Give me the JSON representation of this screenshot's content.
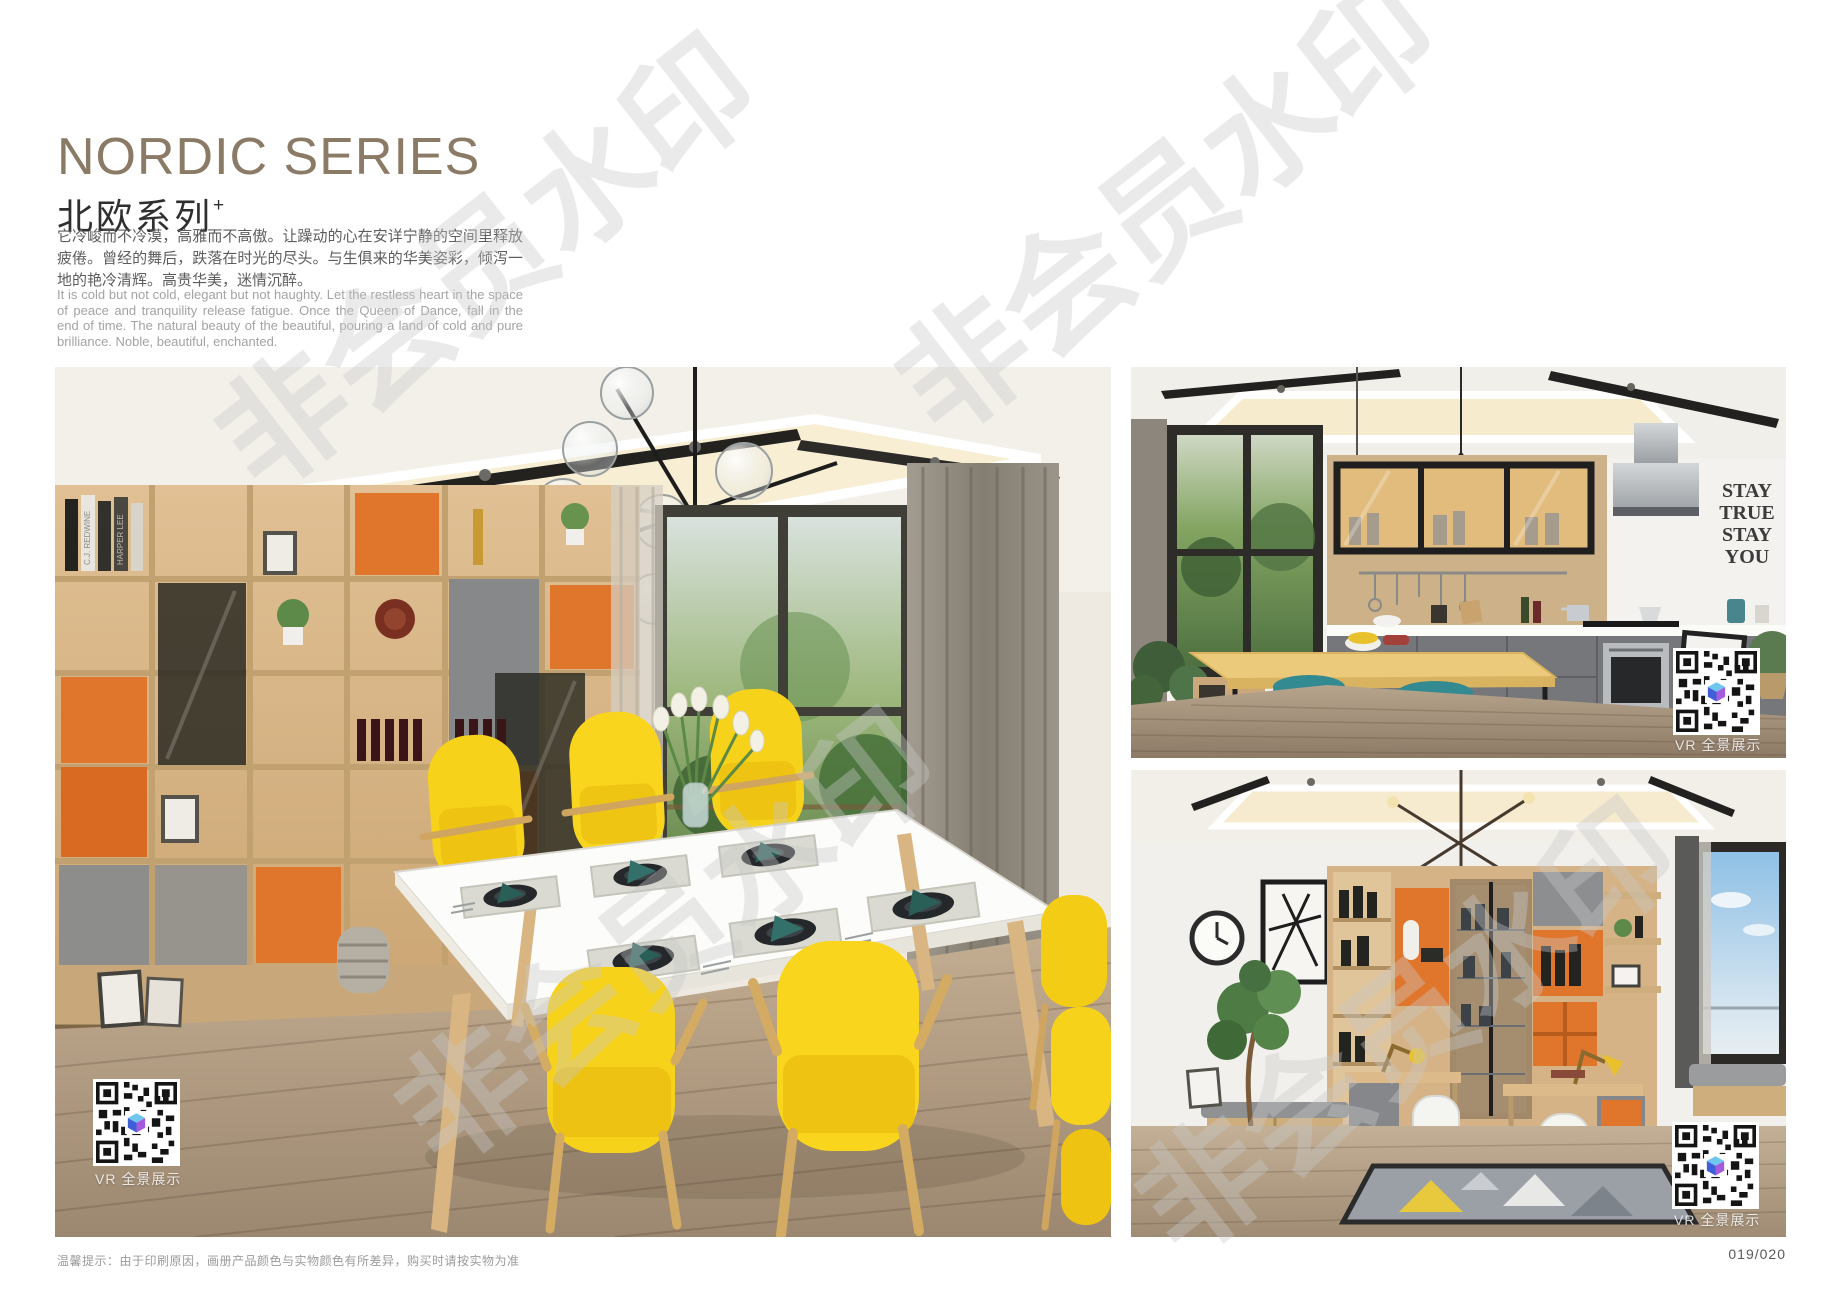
{
  "header": {
    "title_en": "NORDIC SERIES",
    "title_cn": "北欧系列",
    "title_sup": "+",
    "desc_cn": "它冷峻而不冷漠，高雅而不高傲。让躁动的心在安详宁静的空间里释放疲倦。曾经的舞后，跌落在时光的尽头。与生俱来的华美姿彩，倾泻一地的艳冷清辉。高贵华美，迷情沉醉。",
    "desc_en": "It is cold but not cold, elegant but not haughty. Let the restless heart in the space of peace and tranquility release fatigue. Once the Queen of Dance, fall in the end of time. The natural beauty of the beautiful, pouring a land of cold and pure brilliance. Noble, beautiful, enchanted."
  },
  "photos": {
    "dining": {
      "vr_label": "VR 全景展示",
      "book_spines": [
        "C.J. REDWINE",
        "HARPER LEE"
      ]
    },
    "kitchen": {
      "vr_label": "VR 全景展示",
      "decal": [
        "STAY",
        "TRUE",
        "STAY",
        "YOU"
      ]
    },
    "study": {
      "vr_label": "VR 全景展示"
    }
  },
  "watermark": {
    "text": "非会员水印"
  },
  "footer": {
    "tip": "温馨提示：由于印刷原因，画册产品颜色与实物颜色有所差异，购买时请按实物为准",
    "page_number": "019/020"
  },
  "colors": {
    "title_bronze": "#8b7a66",
    "accent_orange": "#e0752c",
    "chair_yellow": "#f7d21a",
    "stool_teal": "#2a7b82",
    "napkin_teal": "#2a5f58",
    "watermark_gray": "#c9c9c9"
  }
}
